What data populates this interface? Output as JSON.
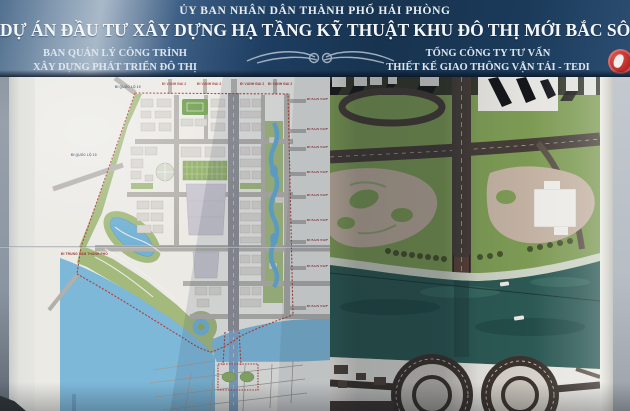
{
  "header": {
    "committee": "ỦY BAN NHÂN DÂN THÀNH PHỐ HẢI PHÒNG",
    "project_title": "DỰ ÁN ĐẦU TƯ XÂY DỰNG HẠ TẦNG KỸ THUẬT KHU ĐÔ THỊ MỚI BẮC SÔNG CẤM",
    "org_left": {
      "line1": "BAN QUẢN LÝ CÔNG TRÌNH",
      "line2": "XÂY DỰNG PHÁT TRIỂN ĐÔ THỊ"
    },
    "org_right": {
      "line1": "TỔNG CÔNG TY TƯ VẤN",
      "line2": "THIẾT KẾ GIAO THÔNG VẬN TẢI - TEDI"
    },
    "icons": {
      "ornament": "wing-flourish-ornament",
      "logo": "tedi-round-red-logo"
    }
  },
  "master_plan_map": {
    "top_road_labels": [
      "ĐI VÀNH ĐAI 2",
      "ĐI VÀNH ĐAI 2",
      "ĐI VÀNH ĐAI 2",
      "ĐI VÀNH ĐAI 2"
    ],
    "west_road_labels": [
      "ĐI QUỐC LỘ 10",
      "ĐI QUỐC LỘ 10"
    ],
    "southwest_road_label": "ĐI TRUNG TÂM THÀNH PHỐ",
    "east_road_labels": [
      "ĐI KCN VSIP",
      "ĐI KCN VSIP",
      "ĐI KCN VSIP",
      "ĐI KCN VSIP",
      "ĐI KCN VSIP",
      "ĐI KCN VSIP",
      "ĐI KCN VSIP",
      "ĐI KCN VSIP",
      "ĐI KCN VSIP"
    ]
  },
  "colors": {
    "header_band": "#1c3a5e",
    "header_glare": "#a9b9c9",
    "logo_red": "#b5201f",
    "plan_water": "#7db8d9",
    "plan_park": "#a3ba7c",
    "plan_boundary_red": "#b23b35",
    "plan_axis_road": "#8f8f94",
    "render_lawn": "#7e9b55",
    "render_river": "#2c5954",
    "render_plaza_tan": "#bfae9d",
    "render_road_dark": "#463d38"
  }
}
